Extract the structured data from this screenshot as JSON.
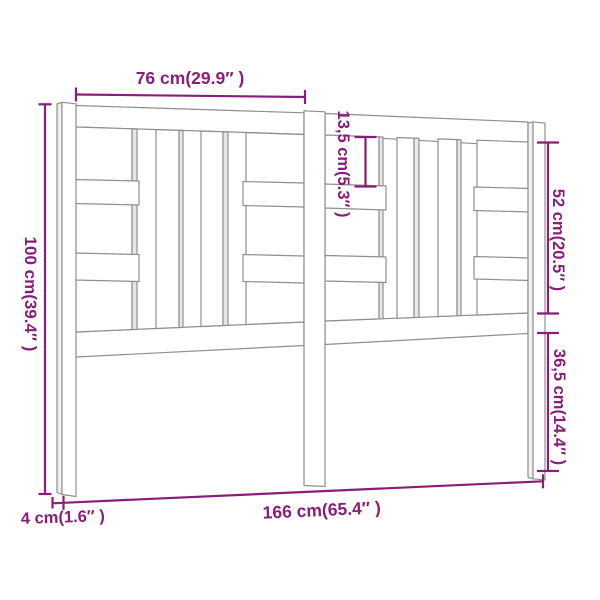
{
  "colors": {
    "accent": "#8a1c7a",
    "outline": "#8f8f8f",
    "face_shade": "#e6e6e6",
    "background": "#ffffff"
  },
  "labels": {
    "top_half_width": "76 cm(29.9″ )",
    "left_height": "100 cm(39.4″ )",
    "inner_gap": "13,5 cm(5.3″ )",
    "right_upper_section": "52 cm(20.5″ )",
    "right_lower_section": "36,5 cm(14.4″ )",
    "bottom_total_width": "166 cm(65.4″ )",
    "post_thickness": "4 cm(1.6″ )"
  }
}
